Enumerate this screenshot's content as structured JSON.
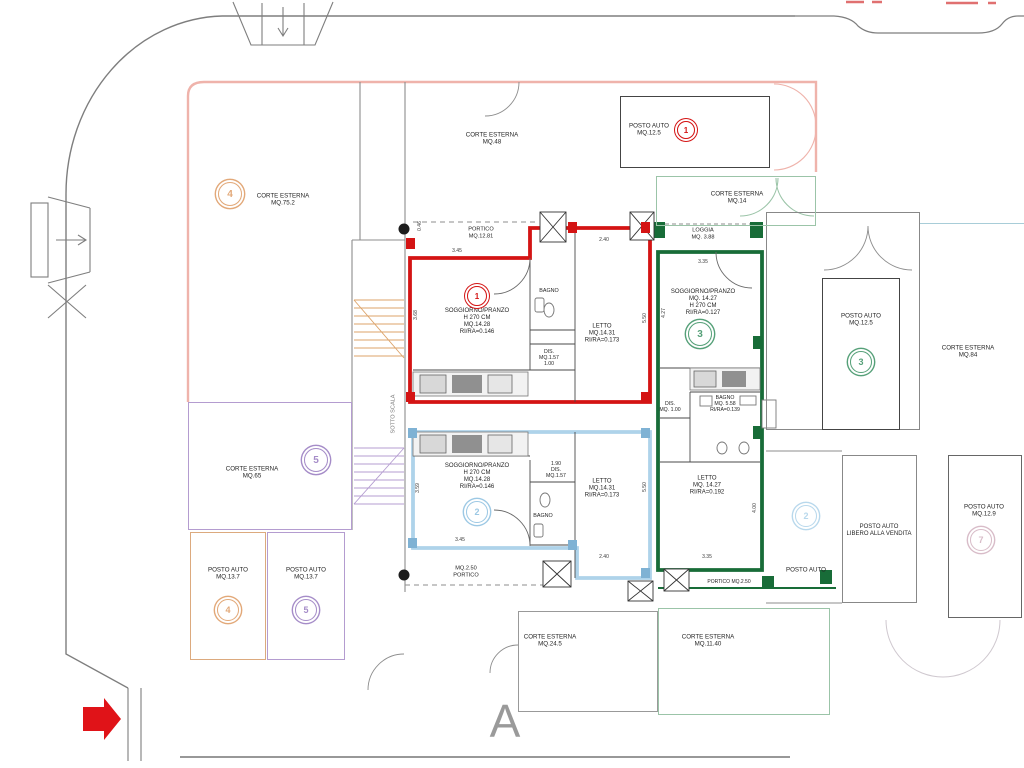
{
  "section_marker": "A",
  "colors": {
    "unit1_red": "#d41414",
    "unit1_salmon": "#efb3ab",
    "unit2_blue": "#aed3ea",
    "unit3_green": "#186c38",
    "unit3_lightgreen": "#9bc4a8",
    "unit4_orange": "#e2a878",
    "unit5_purple": "#a58cc8",
    "unit7_pink": "#d8bcc8",
    "corte84_teal": "#a8cdd8",
    "road_grey": "#7e7e7e",
    "arrow_red": "#e01318"
  },
  "labels": [
    {
      "t": "CORTE ESTERNA\nMQ.75.2",
      "x": 283,
      "y": 200,
      "name": "label-corte-esterna-4"
    },
    {
      "t": "CORTE ESTERNA\nMQ.48",
      "x": 492,
      "y": 139,
      "name": "label-corte-esterna-48"
    },
    {
      "t": "POSTO AUTO\nMQ.12.5",
      "x": 649,
      "y": 130,
      "name": "label-posto-auto-1"
    },
    {
      "t": "CORTE ESTERNA\nMQ.14",
      "x": 737,
      "y": 198,
      "name": "label-corte-esterna-14"
    },
    {
      "t": "PORTICO\nMQ.12.81",
      "x": 481,
      "y": 233,
      "size": 5.6,
      "name": "label-portico-1"
    },
    {
      "t": "LOGGIA\nMQ. 3.88",
      "x": 703,
      "y": 234,
      "size": 5.6,
      "name": "label-loggia-3"
    },
    {
      "t": "SOGGIORNO/PRANZO\nH 270 CM\nMQ.14.28\nRI/RA=0.146",
      "x": 477,
      "y": 322,
      "size": 6,
      "name": "label-soggiorno-1"
    },
    {
      "t": "BAGNO",
      "x": 549,
      "y": 291,
      "size": 5.4,
      "name": "label-bagno-1"
    },
    {
      "t": "DIS.\nMQ.1.57\n1.00",
      "x": 549,
      "y": 358,
      "size": 5.2,
      "name": "label-dis-1"
    },
    {
      "t": "LETTO\nMQ.14.31\nRI/RA=0.173",
      "x": 602,
      "y": 334,
      "size": 6,
      "name": "label-letto-1"
    },
    {
      "t": "SOGGIORNO/PRANZO\nMQ. 14.27\nH 270 CM\nRI/RA=0.127",
      "x": 703,
      "y": 303,
      "size": 6,
      "name": "label-soggiorno-3"
    },
    {
      "t": "CORTE ESTERNA\nMQ.84",
      "x": 968,
      "y": 352,
      "name": "label-corte-esterna-84"
    },
    {
      "t": "POSTO AUTO\nMQ.12.5",
      "x": 861,
      "y": 320,
      "name": "label-posto-auto-3"
    },
    {
      "t": "DIS.\nMQ. 1.00",
      "x": 670,
      "y": 407,
      "size": 5.2,
      "name": "label-dis-3"
    },
    {
      "t": "BAGNO\nMQ. 5.58\nRI/RA=0.139",
      "x": 725,
      "y": 404,
      "size": 5.2,
      "name": "label-bagno-3"
    },
    {
      "t": "LETTO\nMQ. 14.27\nRI/RA=0.192",
      "x": 707,
      "y": 486,
      "size": 6,
      "name": "label-letto-3"
    },
    {
      "t": "SOGGIORNO/PRANZO\nH 270 CM\nMQ.14.28\nRI/RA=0.146",
      "x": 477,
      "y": 477,
      "size": 6,
      "name": "label-soggiorno-2"
    },
    {
      "t": "1.90\nDIS.\nMQ.1.57",
      "x": 556,
      "y": 470,
      "size": 5.2,
      "name": "label-dis-2"
    },
    {
      "t": "BAGNO",
      "x": 543,
      "y": 516,
      "size": 5.4,
      "name": "label-bagno-2"
    },
    {
      "t": "LETTO\nMQ.14.31\nRI/RA=0.173",
      "x": 602,
      "y": 489,
      "size": 6,
      "name": "label-letto-2"
    },
    {
      "t": "MQ.2.50\nPORTICO",
      "x": 466,
      "y": 572,
      "size": 5.6,
      "name": "label-portico-2"
    },
    {
      "t": "PORTICO MQ.2.50",
      "x": 729,
      "y": 583,
      "size": 5,
      "name": "label-portico-3"
    },
    {
      "t": "CORTE ESTERNA\nMQ.65",
      "x": 252,
      "y": 473,
      "name": "label-corte-esterna-5"
    },
    {
      "t": "POSTO AUTO\nMQ.13.7",
      "x": 228,
      "y": 574,
      "name": "label-posto-auto-4"
    },
    {
      "t": "POSTO AUTO\nMQ.13.7",
      "x": 306,
      "y": 574,
      "name": "label-posto-auto-5"
    },
    {
      "t": "POSTO AUTO",
      "x": 806,
      "y": 570,
      "name": "label-posto-auto-2"
    },
    {
      "t": "POSTO AUTO\nLIBERO ALLA VENDITA",
      "x": 879,
      "y": 531,
      "size": 6,
      "name": "label-posto-auto-libero"
    },
    {
      "t": "POSTO AUTO\nMQ.12.9",
      "x": 984,
      "y": 511,
      "name": "label-posto-auto-7"
    },
    {
      "t": "CORTE ESTERNA\nMQ.24.5",
      "x": 550,
      "y": 641,
      "name": "label-corte-esterna-245"
    },
    {
      "t": "CORTE ESTERNA\nMQ.11.40",
      "x": 708,
      "y": 641,
      "name": "label-corte-esterna-1140"
    },
    {
      "t": "SOTTO SCALA",
      "x": 394,
      "y": 414,
      "rot": -90,
      "size": 5.6,
      "color": "#777777",
      "name": "label-sotto-scala"
    }
  ],
  "dims": [
    {
      "t": "3.45",
      "x": 457,
      "y": 251
    },
    {
      "t": "2.40",
      "x": 604,
      "y": 240
    },
    {
      "t": "0.46",
      "x": 420,
      "y": 226,
      "rot": -90
    },
    {
      "t": "5.50",
      "x": 645,
      "y": 318,
      "rot": -90
    },
    {
      "t": "3.68",
      "x": 416,
      "y": 315,
      "rot": -90
    },
    {
      "t": "3.35",
      "x": 703,
      "y": 262
    },
    {
      "t": "4.27",
      "x": 664,
      "y": 313,
      "rot": -90
    },
    {
      "t": "3.35",
      "x": 707,
      "y": 557
    },
    {
      "t": "4.00",
      "x": 755,
      "y": 508,
      "rot": -90
    },
    {
      "t": "3.45",
      "x": 460,
      "y": 540
    },
    {
      "t": "3.59",
      "x": 418,
      "y": 488,
      "rot": -90
    },
    {
      "t": "5.50",
      "x": 645,
      "y": 487,
      "rot": -90
    },
    {
      "t": "2.40",
      "x": 604,
      "y": 557
    }
  ],
  "area_boxes": [
    {
      "name": "posto-auto-1-box",
      "x": 620,
      "y": 96,
      "w": 150,
      "h": 72,
      "stroke": "#444444",
      "sw": 1
    },
    {
      "name": "corte-esterna-5-box",
      "x": 188,
      "y": 402,
      "w": 164,
      "h": 128,
      "stroke": "#b49cd0",
      "sw": 1.4
    },
    {
      "name": "posto-auto-4-box",
      "x": 190,
      "y": 532,
      "w": 76,
      "h": 128,
      "stroke": "#dcaa7e",
      "sw": 1.4
    },
    {
      "name": "posto-auto-5-box",
      "x": 267,
      "y": 532,
      "w": 78,
      "h": 128,
      "stroke": "#b49cd0",
      "sw": 1.4
    },
    {
      "name": "garage-wing-box",
      "x": 766,
      "y": 212,
      "w": 154,
      "h": 218,
      "stroke": "#888888",
      "sw": 1.2
    },
    {
      "name": "posto-auto-3-box",
      "x": 822,
      "y": 278,
      "w": 78,
      "h": 152,
      "stroke": "#444444",
      "sw": 1
    },
    {
      "name": "posto-auto-libero-box",
      "x": 842,
      "y": 455,
      "w": 75,
      "h": 148,
      "stroke": "#888888",
      "sw": 1.1
    },
    {
      "name": "posto-auto-7-box",
      "x": 948,
      "y": 455,
      "w": 74,
      "h": 163,
      "stroke": "#666666",
      "sw": 1.1
    },
    {
      "name": "corte-esterna-245-box",
      "x": 518,
      "y": 611,
      "w": 140,
      "h": 101,
      "stroke": "#999999",
      "sw": 1.1
    },
    {
      "name": "corte-esterna-1140-box",
      "x": 658,
      "y": 608,
      "w": 172,
      "h": 107,
      "stroke": "#9bc4a8",
      "sw": 1.3
    },
    {
      "name": "corte-esterna-14-box",
      "x": 656,
      "y": 176,
      "w": 160,
      "h": 50,
      "stroke": "#9bc4a8",
      "sw": 1.3
    },
    {
      "name": "corte-esterna-84-edge",
      "x": 920,
      "y": 223,
      "w": 104,
      "h": 207,
      "stroke": "#a8cdd8",
      "sw": 1.6,
      "sides": "top"
    }
  ],
  "badges": [
    {
      "n": "1",
      "c": "#d41414",
      "x": 686,
      "y": 130,
      "r": 8
    },
    {
      "n": "4",
      "c": "#e2a878",
      "x": 230,
      "y": 194,
      "r": 11
    },
    {
      "n": "1",
      "c": "#d41414",
      "x": 477,
      "y": 296,
      "r": 9
    },
    {
      "n": "3",
      "c": "#55a078",
      "x": 700,
      "y": 334,
      "r": 11
    },
    {
      "n": "3",
      "c": "#55a078",
      "x": 861,
      "y": 362,
      "r": 10
    },
    {
      "n": "5",
      "c": "#a58cc8",
      "x": 316,
      "y": 460,
      "r": 11
    },
    {
      "n": "2",
      "c": "#9cc8e4",
      "x": 477,
      "y": 512,
      "r": 10
    },
    {
      "n": "4",
      "c": "#e2a878",
      "x": 228,
      "y": 610,
      "r": 10
    },
    {
      "n": "5",
      "c": "#a58cc8",
      "x": 306,
      "y": 610,
      "r": 10
    },
    {
      "n": "2",
      "c": "#b8d8ec",
      "x": 806,
      "y": 516,
      "r": 10
    },
    {
      "n": "7",
      "c": "#d8bcc8",
      "x": 981,
      "y": 540,
      "r": 10
    }
  ]
}
